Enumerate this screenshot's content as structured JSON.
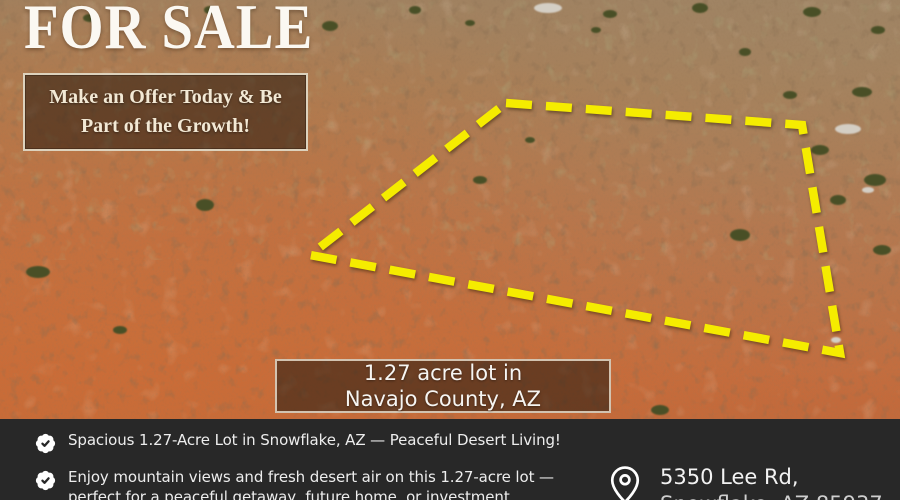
{
  "colors": {
    "boundary_yellow": "#f5ec00",
    "bar_background": "#282828",
    "banner_border": "#ddd2bd",
    "headline_text": "#fbf8f2",
    "desert_orange": "#c06a3c"
  },
  "headline": {
    "title": "FOR SALE"
  },
  "offer_banner": {
    "line1": "Make an Offer Today & Be",
    "line2": "Part of the Growth!"
  },
  "lot_banner": {
    "line1": "1.27 acre lot in",
    "line2": "Navajo County, AZ"
  },
  "features": [
    {
      "icon": "badge-check-icon",
      "text": "Spacious 1.27-Acre Lot in Snowflake, AZ — Peaceful Desert Living!"
    },
    {
      "icon": "badge-check-icon",
      "text": "Enjoy mountain views and fresh desert air on this 1.27-acre lot — perfect for a peaceful getaway, future home, or investment"
    }
  ],
  "address": {
    "icon": "map-pin-icon",
    "line1": "5350 Lee Rd,",
    "line2": "Snowflake, AZ 85937"
  }
}
